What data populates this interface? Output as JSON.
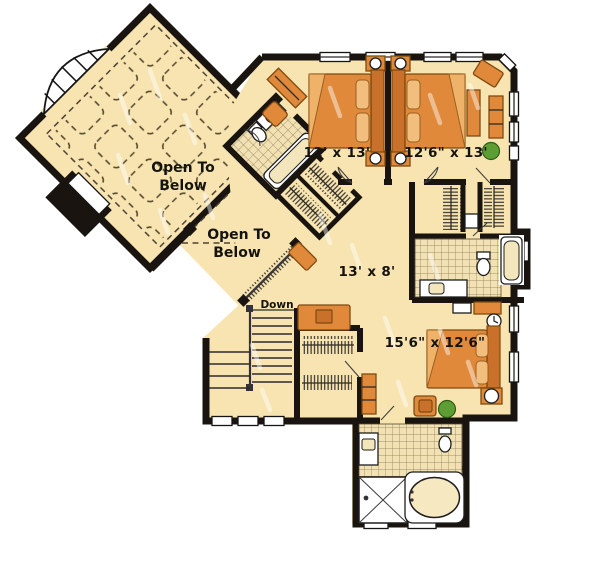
{
  "floor_plan": {
    "rooms": {
      "open_to_below_upper": {
        "label_line1": "Open To",
        "label_line2": "Below"
      },
      "open_to_below_lower": {
        "label_line1": "Open To",
        "label_line2": "Below"
      },
      "bedroom_1": {
        "dimension_label": "12' x 13'"
      },
      "bedroom_2": {
        "dimension_label": "12'6\" x 13'"
      },
      "hallway": {
        "dimension_label": "13' x 8'"
      },
      "master_bedroom": {
        "dimension_label": "15'6\" x 12'6\""
      },
      "stairs": {
        "label": "Down"
      }
    },
    "colors": {
      "floor": "#F7E4B0",
      "wall": "#19140F",
      "furniture": "#E0893B",
      "furniture_dark": "#C9702A",
      "furniture_stroke": "#7E4A10",
      "plant": "#5C9E33"
    }
  }
}
